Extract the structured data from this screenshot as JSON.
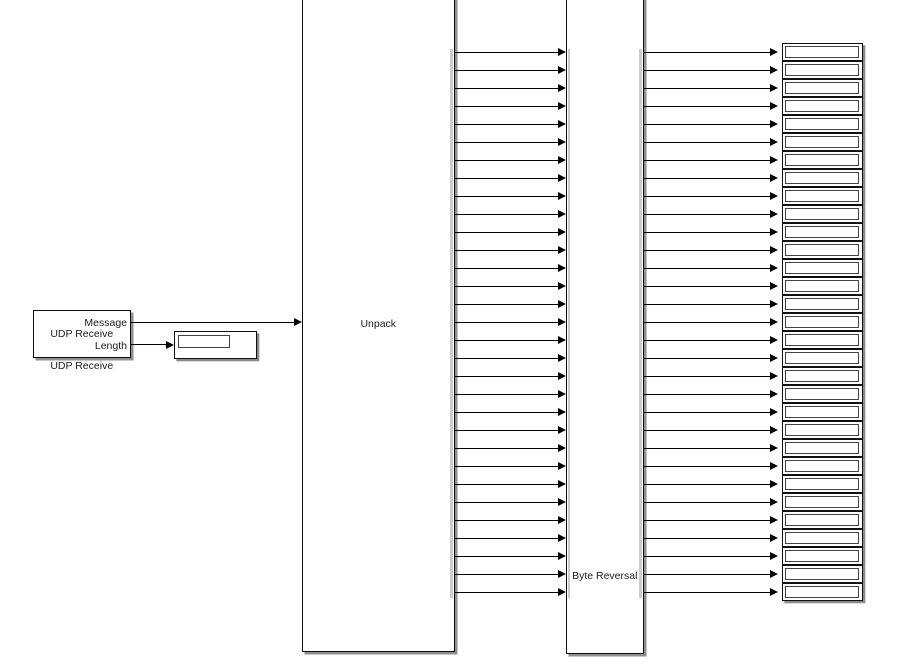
{
  "diagram": {
    "background_color": "#ffffff",
    "wire_color": "#000000",
    "block_fill_color": "#ffffff",
    "block_border_color": "#0f0f0f",
    "shadow_color": "#8f8f8f",
    "udp_block": {
      "label": "UDP Receive",
      "caption": "UDP Receive",
      "output_ports": [
        "Message",
        "Length"
      ]
    },
    "length_display": {
      "value": ""
    },
    "unpack_block": {
      "label": "Unpack",
      "input_count": 1,
      "output_count": 31
    },
    "byte_reversal_block": {
      "label": "Byte Reversal",
      "input_count": 31,
      "output_count": 31
    },
    "display_stack": {
      "count": 31,
      "value": ""
    }
  }
}
